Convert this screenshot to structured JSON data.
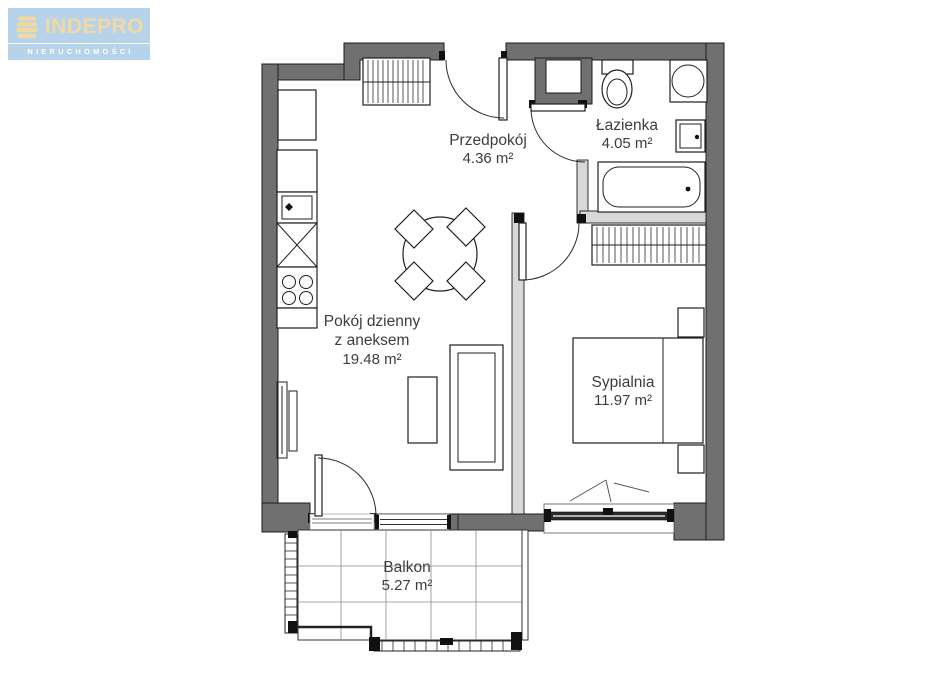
{
  "logo": {
    "company": "INDEPRO",
    "tagline": "NIERUCHOMOŚCI"
  },
  "rooms": {
    "przedpokoj": {
      "name": "Przedpokój",
      "area": "4.36 m²"
    },
    "lazienka": {
      "name": "Łazienka",
      "area": "4.05 m²"
    },
    "pokoj_dzienny": {
      "name": "Pokój dzienny",
      "name2": "z aneksem",
      "area": "19.48 m²"
    },
    "sypialnia": {
      "name": "Sypialnia",
      "area": "11.97 m²"
    },
    "balkon": {
      "name": "Balkon",
      "area": "5.27 m²"
    }
  },
  "colors": {
    "exterior_wall": "#707070",
    "interior_wall": "#d8d8d8",
    "logo_bg": "#b7d3e9",
    "logo_text": "#f2d9a2",
    "logo_tagline": "#ffffff"
  }
}
